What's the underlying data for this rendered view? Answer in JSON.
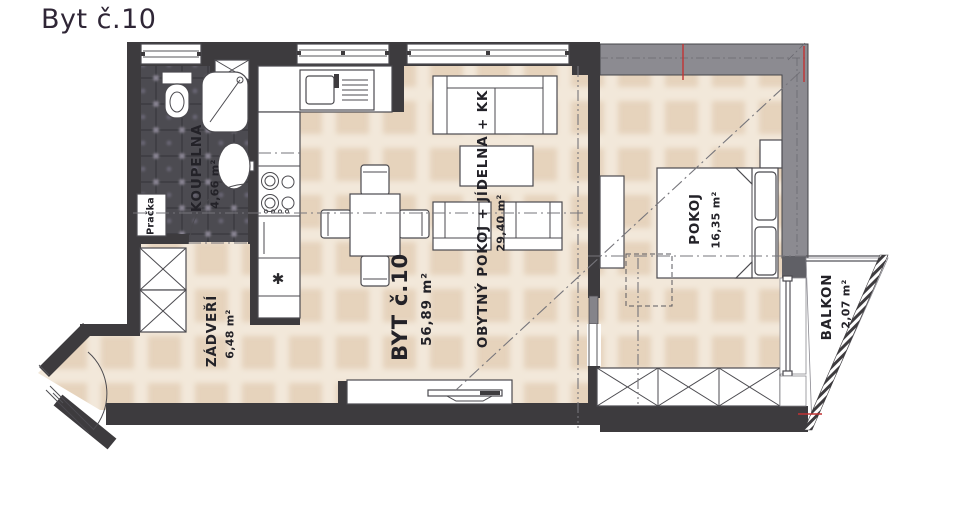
{
  "title": "Byt č.10",
  "rooms": [
    {
      "name": "KOUPELNA",
      "area": "4,66 m²"
    },
    {
      "name": "ZÁDVEŘÍ",
      "area": "6,48 m²"
    },
    {
      "name": "BYT č.10",
      "area": "56,89 m²"
    },
    {
      "name": "OBYTNÝ POKOJ + JÍDELNA + KK",
      "area": "29,40 m²"
    },
    {
      "name": "POKOJ",
      "area": "16,35 m²"
    },
    {
      "name": "BALKON",
      "area": "2,07 m²"
    }
  ],
  "appliances": {
    "washer": "Pračka",
    "dishwasher_symbol": "✱"
  },
  "colors": {
    "wall": "#3d3b3e",
    "gray_wall": "#8c8b91",
    "floor": "#f2e8da",
    "floor_block": "#d9bd9e",
    "bath_floor": "#4c4b51",
    "marker_red": "#c23333",
    "title_text": "#2f2636",
    "label_text": "#232228"
  }
}
